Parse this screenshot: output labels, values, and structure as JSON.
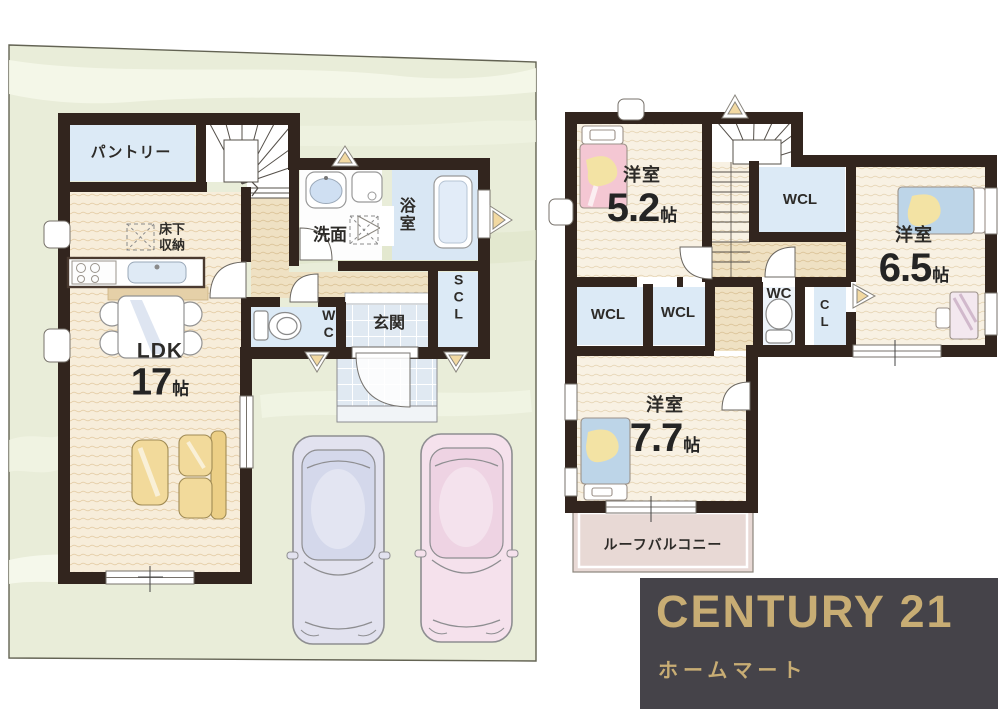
{
  "floor1": {
    "pantry": "パントリー",
    "washroom": "洗面",
    "bath": "浴室",
    "underfloor_line1": "床下",
    "underfloor_line2": "収納",
    "ldk": {
      "name": "LDK",
      "size": "17",
      "unit": "帖"
    },
    "wc": "WC",
    "entrance": "玄関",
    "scl": "SCL"
  },
  "floor2": {
    "room52": {
      "type": "洋室",
      "size": "5.2",
      "unit": "帖"
    },
    "wcl_top": "WCL",
    "room65": {
      "type": "洋室",
      "size": "6.5",
      "unit": "帖"
    },
    "wcl_left": "WCL",
    "wcl_mid": "WCL",
    "wc": "WC",
    "cl": "CL",
    "room77": {
      "type": "洋室",
      "size": "7.7",
      "unit": "帖"
    },
    "balcony": "ルーフバルコニー"
  },
  "logo": {
    "brand": "CENTURY 21",
    "store": "ホームマート"
  },
  "colors": {
    "wall": "#32251e",
    "site_green": "#e9edd9",
    "site_streak": "#f5f7e9",
    "wood_floor": "#f7edda",
    "hall_floor": "#efe1c3",
    "room_blue": "#dceaf6",
    "bath_blue": "#d9e7f4",
    "tile_blue": "#e0e9f2",
    "balcony_pink": "#e8d9d5",
    "bed_pink": "#f4c7d3",
    "bed_blue": "#bdd5e8",
    "pillow_yellow": "#f3e3a4",
    "sofa_yellow": "#f2da9b",
    "car_blue": "#e2e2ef",
    "car_pink": "#f5e1ec",
    "logo_bg": "#454349",
    "logo_gold": "#c8ad74"
  }
}
